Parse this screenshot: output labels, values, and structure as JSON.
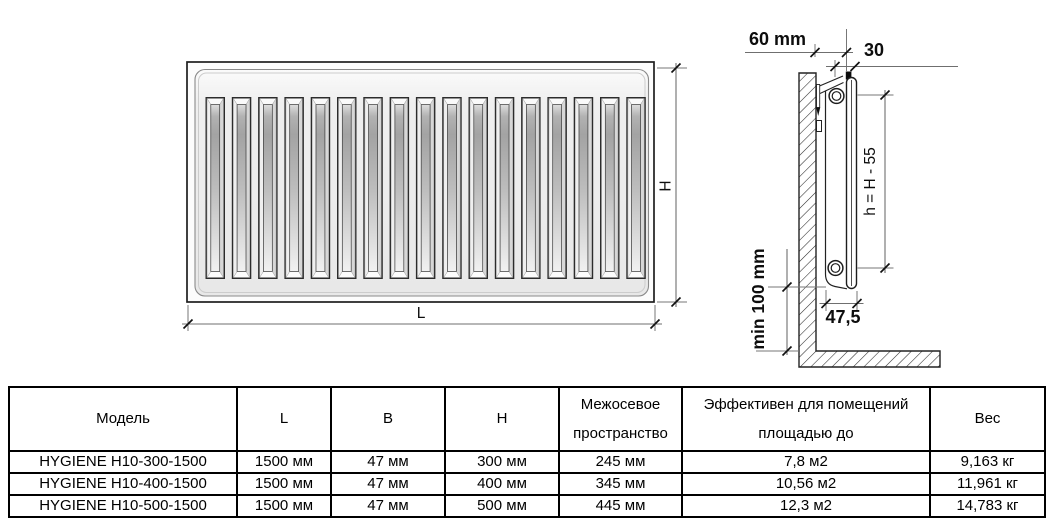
{
  "drawing": {
    "front_view": {
      "length_label": "L",
      "height_label": "H",
      "slat_count": 17
    },
    "side_view": {
      "wall_distance_label": "60 mm",
      "top_offset_label": "30",
      "axis_height_label": "h = H - 55",
      "floor_clearance_label": "min 100 mm",
      "depth_label": "47,5"
    }
  },
  "table": {
    "headers": [
      {
        "line1": "Модель"
      },
      {
        "line1": "L"
      },
      {
        "line1": "B"
      },
      {
        "line1": "H"
      },
      {
        "line1": "Межосевое",
        "line2": "пространство"
      },
      {
        "line1": "Эффективен для помещений",
        "line2": "площадью до"
      },
      {
        "line1": "Вес"
      }
    ],
    "rows": [
      {
        "cells": [
          "HYGIENE H10-300-1500",
          "1500 мм",
          "47 мм",
          "300 мм",
          "245 мм",
          "7,8 м2",
          "9,163 кг"
        ]
      },
      {
        "cells": [
          "HYGIENE H10-400-1500",
          "1500 мм",
          "47 мм",
          "400 мм",
          "345 мм",
          "10,56 м2",
          "11,961 кг"
        ]
      },
      {
        "cells": [
          "HYGIENE H10-500-1500",
          "1500 мм",
          "47 мм",
          "500 мм",
          "445 мм",
          "12,3 м2",
          "14,783 кг"
        ]
      }
    ]
  },
  "colors": {
    "outline": "#1e1e1e",
    "dimension_line": "#6f6f6f",
    "radiator_face": "#ededed",
    "slat_dark": "#a3a3a3",
    "table_border": "#000000",
    "background": "#ffffff"
  }
}
